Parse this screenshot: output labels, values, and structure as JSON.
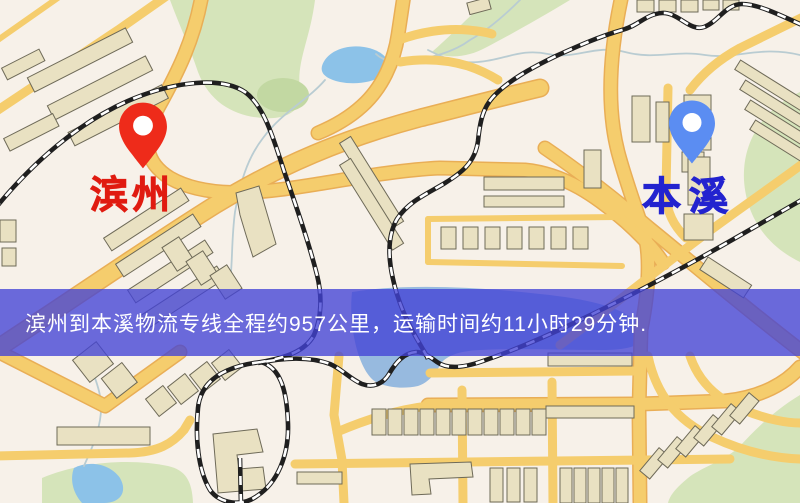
{
  "map": {
    "origin": {
      "label": "滨州",
      "pin_color": "#ee2b1a",
      "label_color": "#e01b10"
    },
    "destination": {
      "label": "本溪",
      "pin_color": "#5b8df2",
      "label_color": "#2323cf"
    },
    "banner": {
      "text": "滨州到本溪物流专线全程约957公里，运输时间约11小时29分钟.",
      "bg_color": "#4343d6",
      "text_color": "#ffffff"
    },
    "palette": {
      "background": "#f7f1e9",
      "road": "#f5cd6d",
      "road_casing": "#e9ae56",
      "park": "#d5e4ba",
      "park_dark": "#c2d8a2",
      "water": "#8cc2e8",
      "lake": "#97badf",
      "building": "#e9e1c2",
      "building_outline": "#6e6a58",
      "railway": "#1f1f1f",
      "railway_dash": "#ffffff",
      "stream": "#b9ccd2"
    }
  }
}
